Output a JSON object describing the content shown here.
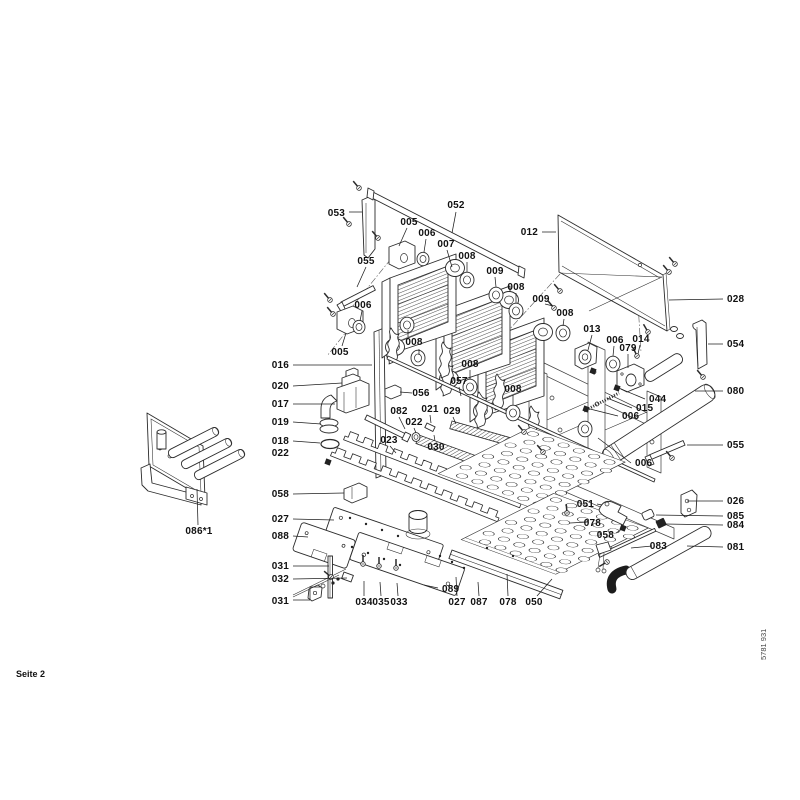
{
  "page": {
    "footer_left": "Seite 2",
    "footer_right": "5781 931"
  },
  "diagram": {
    "description": "Exploded parts view of boiler heating block assembly",
    "labels": [
      {
        "t": "053",
        "x": 345,
        "y": 216,
        "a": "end",
        "leaders": [
          [
            [
              349,
              212
            ],
            [
              362,
              212
            ]
          ]
        ]
      },
      {
        "t": "052",
        "x": 456,
        "y": 208,
        "a": "middle",
        "leaders": [
          [
            [
              456,
              212
            ],
            [
              452,
              233
            ]
          ]
        ]
      },
      {
        "t": "005",
        "x": 409,
        "y": 225,
        "a": "middle",
        "leaders": [
          [
            [
              407,
              228
            ],
            [
              399,
              246
            ]
          ]
        ]
      },
      {
        "t": "006",
        "x": 427,
        "y": 236,
        "a": "middle",
        "leaders": [
          [
            [
              426,
              239
            ],
            [
              424,
              252
            ]
          ]
        ]
      },
      {
        "t": "007",
        "x": 446,
        "y": 247,
        "a": "middle",
        "leaders": [
          [
            [
              447,
              250
            ],
            [
              452,
              267
            ]
          ]
        ]
      },
      {
        "t": "008",
        "x": 467,
        "y": 259,
        "a": "middle",
        "leaders": [
          [
            [
              467,
              262
            ],
            [
              467,
              272
            ]
          ]
        ]
      },
      {
        "t": "009",
        "x": 495,
        "y": 274,
        "a": "middle",
        "leaders": [
          [
            [
              495,
              277
            ],
            [
              496,
              287
            ]
          ]
        ]
      },
      {
        "t": "012",
        "x": 538,
        "y": 235,
        "a": "end",
        "leaders": [
          [
            [
              542,
              232
            ],
            [
              556,
              232
            ]
          ]
        ]
      },
      {
        "t": "008",
        "x": 516,
        "y": 290,
        "a": "middle",
        "leaders": [
          [
            [
              516,
              293
            ],
            [
              516,
              303
            ]
          ]
        ]
      },
      {
        "t": "009",
        "x": 541,
        "y": 302,
        "a": "middle",
        "leaders": [
          [
            [
              545,
              304
            ],
            [
              553,
              306
            ]
          ]
        ]
      },
      {
        "t": "008",
        "x": 565,
        "y": 316,
        "a": "middle",
        "leaders": [
          [
            [
              564,
              319
            ],
            [
              563,
              326
            ]
          ]
        ]
      },
      {
        "t": "028",
        "x": 727,
        "y": 302,
        "a": "start",
        "leaders": [
          [
            [
              723,
              299
            ],
            [
              669,
              300
            ]
          ]
        ]
      },
      {
        "t": "054",
        "x": 727,
        "y": 347,
        "a": "start",
        "leaders": [
          [
            [
              723,
              344
            ],
            [
              708,
              344
            ]
          ]
        ]
      },
      {
        "t": "080",
        "x": 727,
        "y": 394,
        "a": "start",
        "leaders": [
          [
            [
              723,
              391
            ],
            [
              695,
              391
            ]
          ]
        ]
      },
      {
        "t": "055",
        "x": 727,
        "y": 448,
        "a": "start",
        "leaders": [
          [
            [
              723,
              445
            ],
            [
              687,
              445
            ]
          ]
        ]
      },
      {
        "t": "026",
        "x": 727,
        "y": 504,
        "a": "start",
        "leaders": [
          [
            [
              723,
              501
            ],
            [
              687,
              501
            ]
          ]
        ]
      },
      {
        "t": "085",
        "x": 727,
        "y": 519,
        "a": "start",
        "leaders": [
          [
            [
              723,
              516
            ],
            [
              656,
              515
            ]
          ]
        ]
      },
      {
        "t": "084",
        "x": 727,
        "y": 528,
        "a": "start",
        "leaders": [
          [
            [
              723,
              525
            ],
            [
              665,
              524
            ]
          ]
        ]
      },
      {
        "t": "081",
        "x": 727,
        "y": 550,
        "a": "start",
        "leaders": [
          [
            [
              723,
              547
            ],
            [
              687,
              546
            ]
          ]
        ]
      },
      {
        "t": "055",
        "x": 366,
        "y": 264,
        "a": "middle",
        "leaders": [
          [
            [
              366,
              267
            ],
            [
              357,
              287
            ]
          ]
        ]
      },
      {
        "t": "006",
        "x": 363,
        "y": 308,
        "a": "middle",
        "leaders": [
          [
            [
              362,
              311
            ],
            [
              360,
              321
            ]
          ]
        ]
      },
      {
        "t": "005",
        "x": 340,
        "y": 355,
        "a": "middle",
        "leaders": [
          [
            [
              342,
              346
            ],
            [
              346,
              333
            ]
          ]
        ]
      },
      {
        "t": "016",
        "x": 289,
        "y": 368,
        "a": "end",
        "leaders": [
          [
            [
              293,
              365
            ],
            [
              372,
              365
            ]
          ]
        ]
      },
      {
        "t": "020",
        "x": 289,
        "y": 389,
        "a": "end",
        "leaders": [
          [
            [
              293,
              386
            ],
            [
              342,
              383
            ]
          ]
        ]
      },
      {
        "t": "017",
        "x": 289,
        "y": 407,
        "a": "end",
        "leaders": [
          [
            [
              293,
              404
            ],
            [
              335,
              404
            ]
          ]
        ]
      },
      {
        "t": "019",
        "x": 289,
        "y": 425,
        "a": "end",
        "leaders": [
          [
            [
              293,
              422
            ],
            [
              321,
              424
            ]
          ]
        ]
      },
      {
        "t": "018",
        "x": 289,
        "y": 444,
        "a": "end",
        "leaders": [
          [
            [
              293,
              441
            ],
            [
              320,
              443
            ]
          ]
        ]
      },
      {
        "t": "022",
        "x": 289,
        "y": 456,
        "a": "end",
        "leaders": []
      },
      {
        "t": "058",
        "x": 289,
        "y": 497,
        "a": "end",
        "leaders": [
          [
            [
              293,
              494
            ],
            [
              344,
              493
            ]
          ]
        ]
      },
      {
        "t": "027",
        "x": 289,
        "y": 522,
        "a": "end",
        "leaders": [
          [
            [
              293,
              519
            ],
            [
              334,
              520
            ]
          ]
        ]
      },
      {
        "t": "088",
        "x": 289,
        "y": 539,
        "a": "end",
        "leaders": [
          [
            [
              293,
              536
            ],
            [
              308,
              537
            ]
          ]
        ]
      },
      {
        "t": "031",
        "x": 289,
        "y": 569,
        "a": "end",
        "leaders": [
          [
            [
              293,
              566
            ],
            [
              329,
              566
            ]
          ]
        ]
      },
      {
        "t": "032",
        "x": 289,
        "y": 582,
        "a": "end",
        "leaders": [
          [
            [
              293,
              579
            ],
            [
              347,
              578
            ]
          ]
        ]
      },
      {
        "t": "031",
        "x": 289,
        "y": 604,
        "a": "end",
        "leaders": [
          [
            [
              293,
              600
            ],
            [
              310,
              600
            ]
          ],
          [
            [
              310,
              600
            ],
            [
              310,
              587
            ],
            [
              320,
              587
            ]
          ]
        ]
      },
      {
        "t": "034",
        "x": 364,
        "y": 605,
        "a": "middle",
        "leaders": [
          [
            [
              364,
              596
            ],
            [
              364,
              581
            ]
          ]
        ]
      },
      {
        "t": "035",
        "x": 381,
        "y": 605,
        "a": "middle",
        "leaders": [
          [
            [
              381,
              596
            ],
            [
              380,
              582
            ]
          ]
        ]
      },
      {
        "t": "033",
        "x": 399,
        "y": 605,
        "a": "middle",
        "leaders": [
          [
            [
              398,
              596
            ],
            [
              397,
              583
            ]
          ]
        ]
      },
      {
        "t": "089",
        "x": 442,
        "y": 592,
        "a": "start",
        "leaders": [
          [
            [
              438,
              588
            ],
            [
              424,
              585
            ]
          ]
        ]
      },
      {
        "t": "027",
        "x": 457,
        "y": 605,
        "a": "middle",
        "leaders": [
          [
            [
              457,
              596
            ],
            [
              456,
              577
            ]
          ]
        ]
      },
      {
        "t": "087",
        "x": 479,
        "y": 605,
        "a": "middle",
        "leaders": [
          [
            [
              479,
              596
            ],
            [
              478,
              582
            ]
          ]
        ]
      },
      {
        "t": "078",
        "x": 508,
        "y": 605,
        "a": "middle",
        "leaders": [
          [
            [
              508,
              596
            ],
            [
              507,
              574
            ]
          ]
        ]
      },
      {
        "t": "050",
        "x": 534,
        "y": 605,
        "a": "middle",
        "leaders": [
          [
            [
              537,
              596
            ],
            [
              552,
              579
            ]
          ]
        ]
      },
      {
        "t": "086*1",
        "x": 199,
        "y": 534,
        "a": "middle",
        "leaders": [
          [
            [
              198,
              525
            ],
            [
              197,
              489
            ]
          ]
        ]
      },
      {
        "t": "056",
        "x": 421,
        "y": 396,
        "a": "middle",
        "leaders": [
          [
            [
              412,
              393
            ],
            [
              400,
              392
            ]
          ]
        ]
      },
      {
        "t": "082",
        "x": 399,
        "y": 414,
        "a": "middle",
        "leaders": [
          [
            [
              399,
              417
            ],
            [
              405,
              429
            ]
          ]
        ]
      },
      {
        "t": "021",
        "x": 430,
        "y": 412,
        "a": "middle",
        "leaders": [
          [
            [
              430,
              415
            ],
            [
              431,
              423
            ]
          ]
        ]
      },
      {
        "t": "029",
        "x": 452,
        "y": 414,
        "a": "middle",
        "leaders": [
          [
            [
              453,
              417
            ],
            [
              456,
              424
            ]
          ]
        ]
      },
      {
        "t": "022",
        "x": 414,
        "y": 425,
        "a": "middle",
        "leaders": [
          [
            [
              414,
              428
            ],
            [
              416,
              433
            ]
          ]
        ]
      },
      {
        "t": "023",
        "x": 389,
        "y": 443,
        "a": "middle",
        "leaders": [
          [
            [
              390,
              446
            ],
            [
              396,
              453
            ]
          ]
        ]
      },
      {
        "t": "030",
        "x": 436,
        "y": 450,
        "a": "middle",
        "leaders": [
          [
            [
              435,
              441
            ],
            [
              434,
              435
            ]
          ]
        ]
      },
      {
        "t": "057",
        "x": 459,
        "y": 384,
        "a": "middle",
        "leaders": [
          [
            [
              459,
              387
            ],
            [
              461,
              396
            ]
          ]
        ]
      },
      {
        "t": "008",
        "x": 414,
        "y": 345,
        "a": "middle",
        "leaders": [
          [
            [
              408,
              337
            ],
            [
              408,
              330
            ]
          ],
          [
            [
              419,
              349
            ],
            [
              419,
              355
            ]
          ]
        ]
      },
      {
        "t": "008",
        "x": 470,
        "y": 367,
        "a": "middle",
        "leaders": [
          [
            [
              470,
              370
            ],
            [
              470,
              379
            ]
          ]
        ]
      },
      {
        "t": "008",
        "x": 513,
        "y": 392,
        "a": "middle",
        "leaders": [
          [
            [
              513,
              395
            ],
            [
              513,
              405
            ]
          ]
        ]
      },
      {
        "t": "013",
        "x": 592,
        "y": 332,
        "a": "middle",
        "leaders": [
          [
            [
              592,
              335
            ],
            [
              588,
              350
            ]
          ]
        ]
      },
      {
        "t": "006",
        "x": 615,
        "y": 343,
        "a": "middle",
        "leaders": [
          [
            [
              614,
              346
            ],
            [
              613,
              356
            ]
          ]
        ]
      },
      {
        "t": "014",
        "x": 641,
        "y": 342,
        "a": "middle",
        "leaders": [
          [
            [
              640,
              345
            ],
            [
              638,
              354
            ]
          ]
        ]
      },
      {
        "t": "079",
        "x": 628,
        "y": 351,
        "a": "middle",
        "leaders": [
          [
            [
              628,
              354
            ],
            [
              628,
              368
            ]
          ]
        ]
      },
      {
        "t": "044",
        "x": 649,
        "y": 402,
        "a": "start",
        "leaders": [
          [
            [
              645,
              399
            ],
            [
              621,
              389
            ]
          ]
        ]
      },
      {
        "t": "015",
        "x": 636,
        "y": 411,
        "a": "start",
        "leaders": [
          [
            [
              632,
              408
            ],
            [
              607,
              398
            ]
          ]
        ]
      },
      {
        "t": "006",
        "x": 622,
        "y": 419,
        "a": "start",
        "leaders": [
          [
            [
              618,
              416
            ],
            [
              590,
              409
            ]
          ]
        ]
      },
      {
        "t": "006",
        "x": 635,
        "y": 466,
        "a": "start",
        "leaders": [
          [
            [
              631,
              463
            ],
            [
              598,
              438
            ]
          ]
        ]
      },
      {
        "t": "051",
        "x": 594,
        "y": 507,
        "a": "end",
        "leaders": [
          [
            [
              597,
              504
            ],
            [
              602,
              505
            ]
          ]
        ]
      },
      {
        "t": "078",
        "x": 601,
        "y": 526,
        "a": "end",
        "leaders": [
          [
            [
              588,
              522
            ],
            [
              570,
              523
            ]
          ]
        ]
      },
      {
        "t": "058",
        "x": 614,
        "y": 538,
        "a": "end",
        "leaders": [
          [
            [
              616,
              533
            ],
            [
              622,
              529
            ]
          ]
        ]
      },
      {
        "t": "083",
        "x": 667,
        "y": 549,
        "a": "end",
        "leaders": [
          [
            [
              652,
              546
            ],
            [
              631,
              548
            ]
          ]
        ]
      }
    ]
  }
}
